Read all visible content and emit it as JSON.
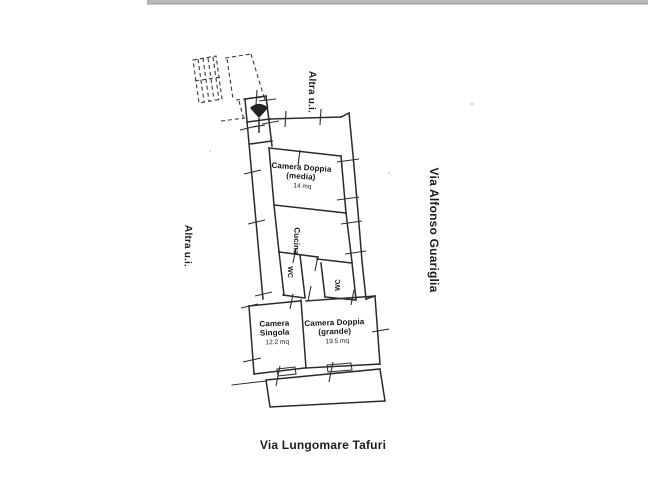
{
  "labels": {
    "adjacent_unit_top": "Altra u.i.",
    "adjacent_unit_left": "Altra u.i.",
    "street_right": "Via Alfonso Guariglia",
    "street_bottom": "Via Lungomare Tafuri"
  },
  "rooms": {
    "camera_doppia_media": {
      "line1": "Camera Doppia",
      "line2": "(media)",
      "area": "14 mq"
    },
    "cucina": {
      "name": "Cucina"
    },
    "wc1": {
      "name": "WC"
    },
    "wc2": {
      "name": "WC"
    },
    "camera_singola": {
      "line1": "Camera",
      "line2": "Singola",
      "area": "12.2 mq"
    },
    "camera_doppia_grande": {
      "line1": "Camera Doppia",
      "line2": "(grande)",
      "area": "19.5 mq"
    }
  },
  "colors": {
    "background": "#ffffff",
    "wall": "#2a2a2a",
    "dashed": "#3a3a3a",
    "tick": "#2f2f2f",
    "text": "#141414",
    "street_text": "#1c1c1c",
    "scan_band": "#b7b7bc",
    "scan_band_edge": "#97979c"
  }
}
